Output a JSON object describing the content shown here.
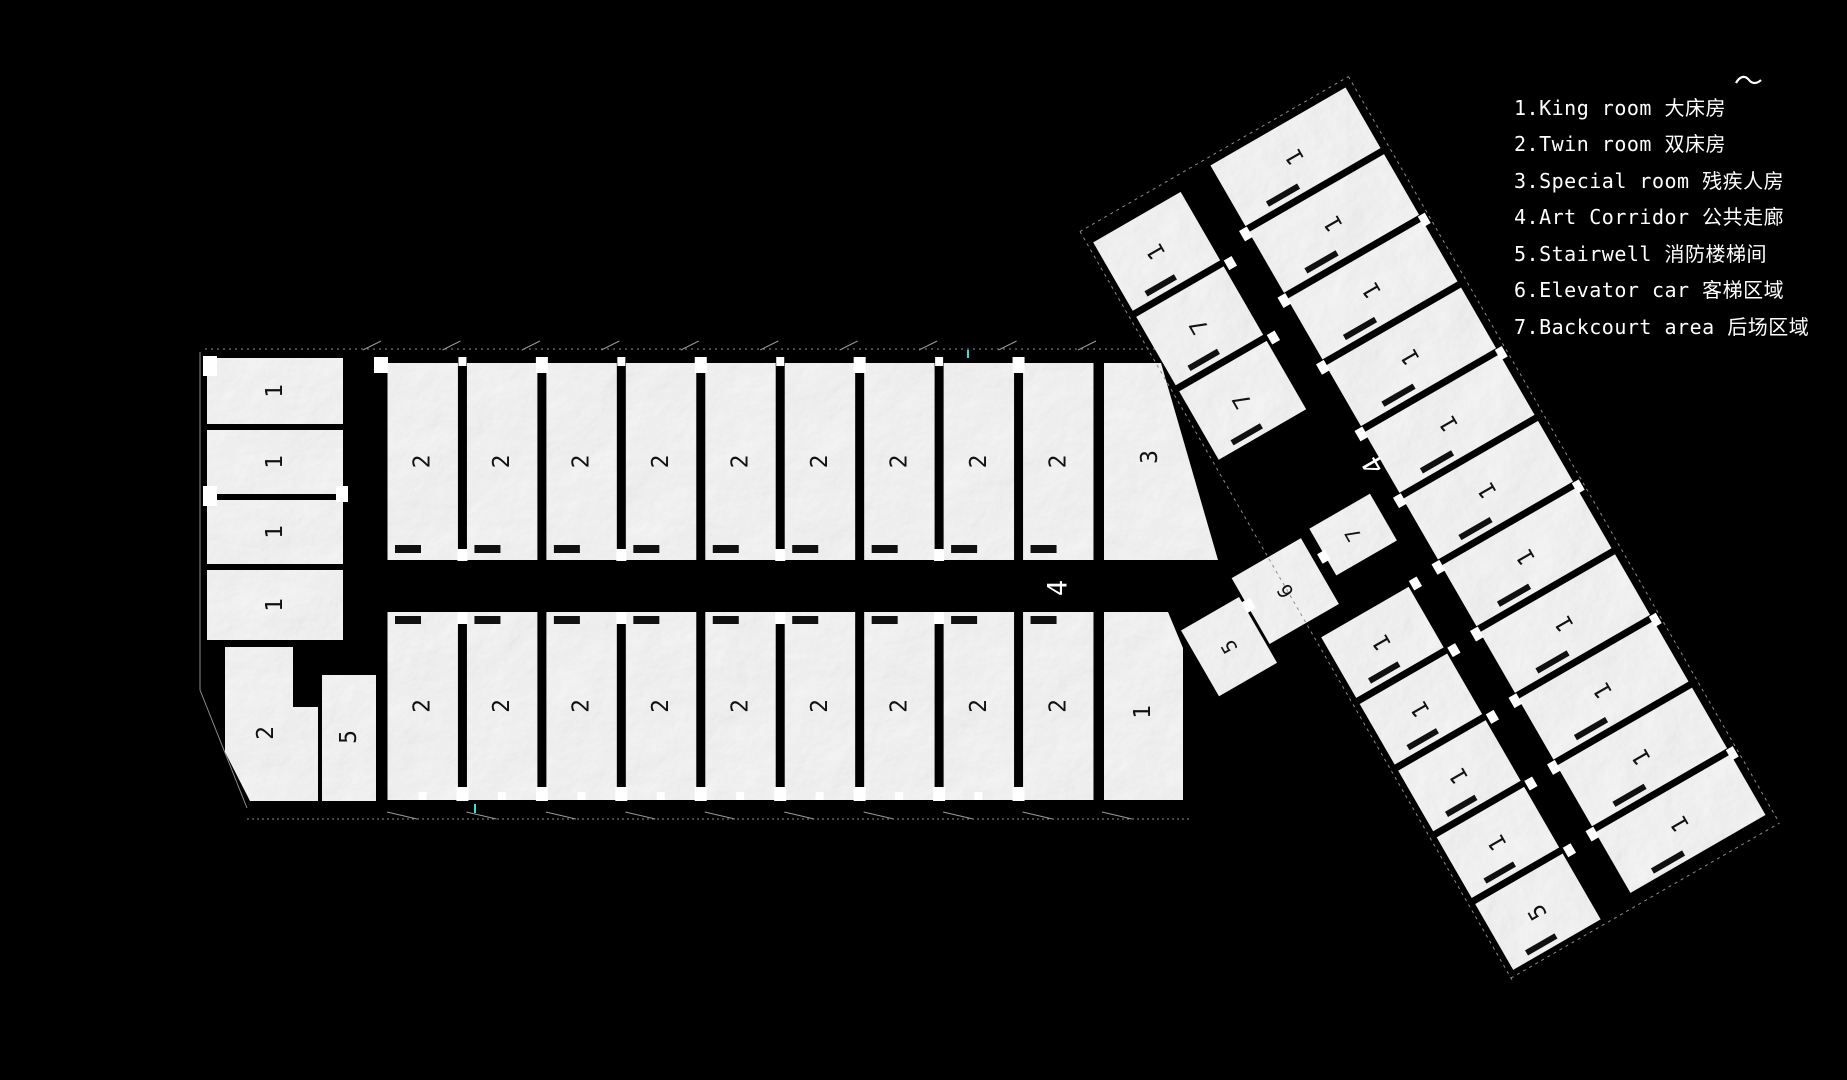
{
  "legend": {
    "items": [
      {
        "text": "1.King room 大床房"
      },
      {
        "text": "2.Twin room 双床房"
      },
      {
        "text": "3.Special room 残疾人房"
      },
      {
        "text": "4.Art Corridor 公共走廊"
      },
      {
        "text": "5.Stairwell 消防楼梯间"
      },
      {
        "text": "6.Elevator car 客梯区域"
      },
      {
        "text": "7.Backcourt area 后场区域"
      }
    ]
  },
  "plan": {
    "colors": {
      "background": "#000000",
      "paper": "#d6d6d6",
      "wall": "#000000",
      "room_label": "#111111",
      "corridor_label": "#ffffff",
      "outline": "#8c8c8c",
      "tick": "#9a9a9a",
      "accent_tick": "#35e0e0"
    },
    "corner_mark": {
      "x": 1736,
      "y": 83
    },
    "horizontal_wing": {
      "left_column": {
        "x": 207,
        "w": 136,
        "label": "1",
        "rooms": [
          {
            "y": 358,
            "h": 66
          },
          {
            "y": 430,
            "h": 64
          },
          {
            "y": 500,
            "h": 64
          },
          {
            "y": 570,
            "h": 70
          }
        ]
      },
      "top_row": {
        "x0": 383,
        "x1": 1098,
        "y": 363,
        "h": 197,
        "count": 9,
        "label": "2"
      },
      "bottom_row": {
        "x0": 383,
        "x1": 1098,
        "y": 612,
        "h": 188,
        "count": 9,
        "label": "2"
      },
      "special_room": {
        "label": "3",
        "points": [
          [
            1104,
            363
          ],
          [
            1161,
            363
          ],
          [
            1218,
            560
          ],
          [
            1104,
            560
          ]
        ],
        "label_at": [
          1150,
          457
        ]
      },
      "end_room": {
        "label": "1",
        "points": [
          [
            1104,
            612
          ],
          [
            1168,
            612
          ],
          [
            1183,
            648
          ],
          [
            1183,
            800
          ],
          [
            1104,
            800
          ]
        ],
        "label_at": [
          1143,
          712
        ]
      },
      "corner_room_2": {
        "label": "2",
        "points": [
          [
            225,
            647
          ],
          [
            293,
            647
          ],
          [
            293,
            707
          ],
          [
            318,
            707
          ],
          [
            318,
            801
          ],
          [
            250,
            801
          ],
          [
            225,
            752
          ]
        ],
        "label_at": [
          266,
          733
        ]
      },
      "corner_room_5": {
        "label": "5",
        "x": 322,
        "y": 675,
        "w": 54,
        "h": 126,
        "label_at": [
          349,
          737
        ]
      },
      "corridor_label": {
        "text": "4",
        "x": 1058,
        "y": 588
      }
    },
    "angled_wing": {
      "pivot": [
        1347,
        82
      ],
      "angle": -30,
      "right_row": {
        "x": -160,
        "w": 156,
        "y0": 4,
        "pitch": 77,
        "room_h": 70,
        "labels": [
          "1",
          "1",
          "1",
          "1",
          "1",
          "1",
          "1",
          "1",
          "1",
          "1",
          "1"
        ]
      },
      "left_row": {
        "x": -300,
        "w": 101,
        "cells": [
          {
            "y": 12,
            "h": 79,
            "label": "1"
          },
          {
            "y": 98,
            "h": 79,
            "label": "7"
          },
          {
            "y": 184,
            "h": 79,
            "label": "7"
          },
          {
            "y": 468,
            "h": 70,
            "label": "1"
          },
          {
            "y": 545,
            "h": 70,
            "label": "1"
          },
          {
            "y": 622,
            "h": 70,
            "label": "1"
          },
          {
            "y": 699,
            "h": 70,
            "label": "1"
          },
          {
            "y": 776,
            "h": 76,
            "label": "5"
          }
        ]
      },
      "junction_rooms": [
        {
          "label": "5",
          "x": -418,
          "y": 392,
          "w": 67,
          "h": 76
        },
        {
          "label": "6",
          "x": -348,
          "y": 372,
          "w": 80,
          "h": 76
        },
        {
          "label": "7",
          "x": -256,
          "y": 368,
          "w": 70,
          "h": 54
        }
      ],
      "corridor_label": {
        "text": "4",
        "x": -168,
        "y": 345
      }
    }
  }
}
